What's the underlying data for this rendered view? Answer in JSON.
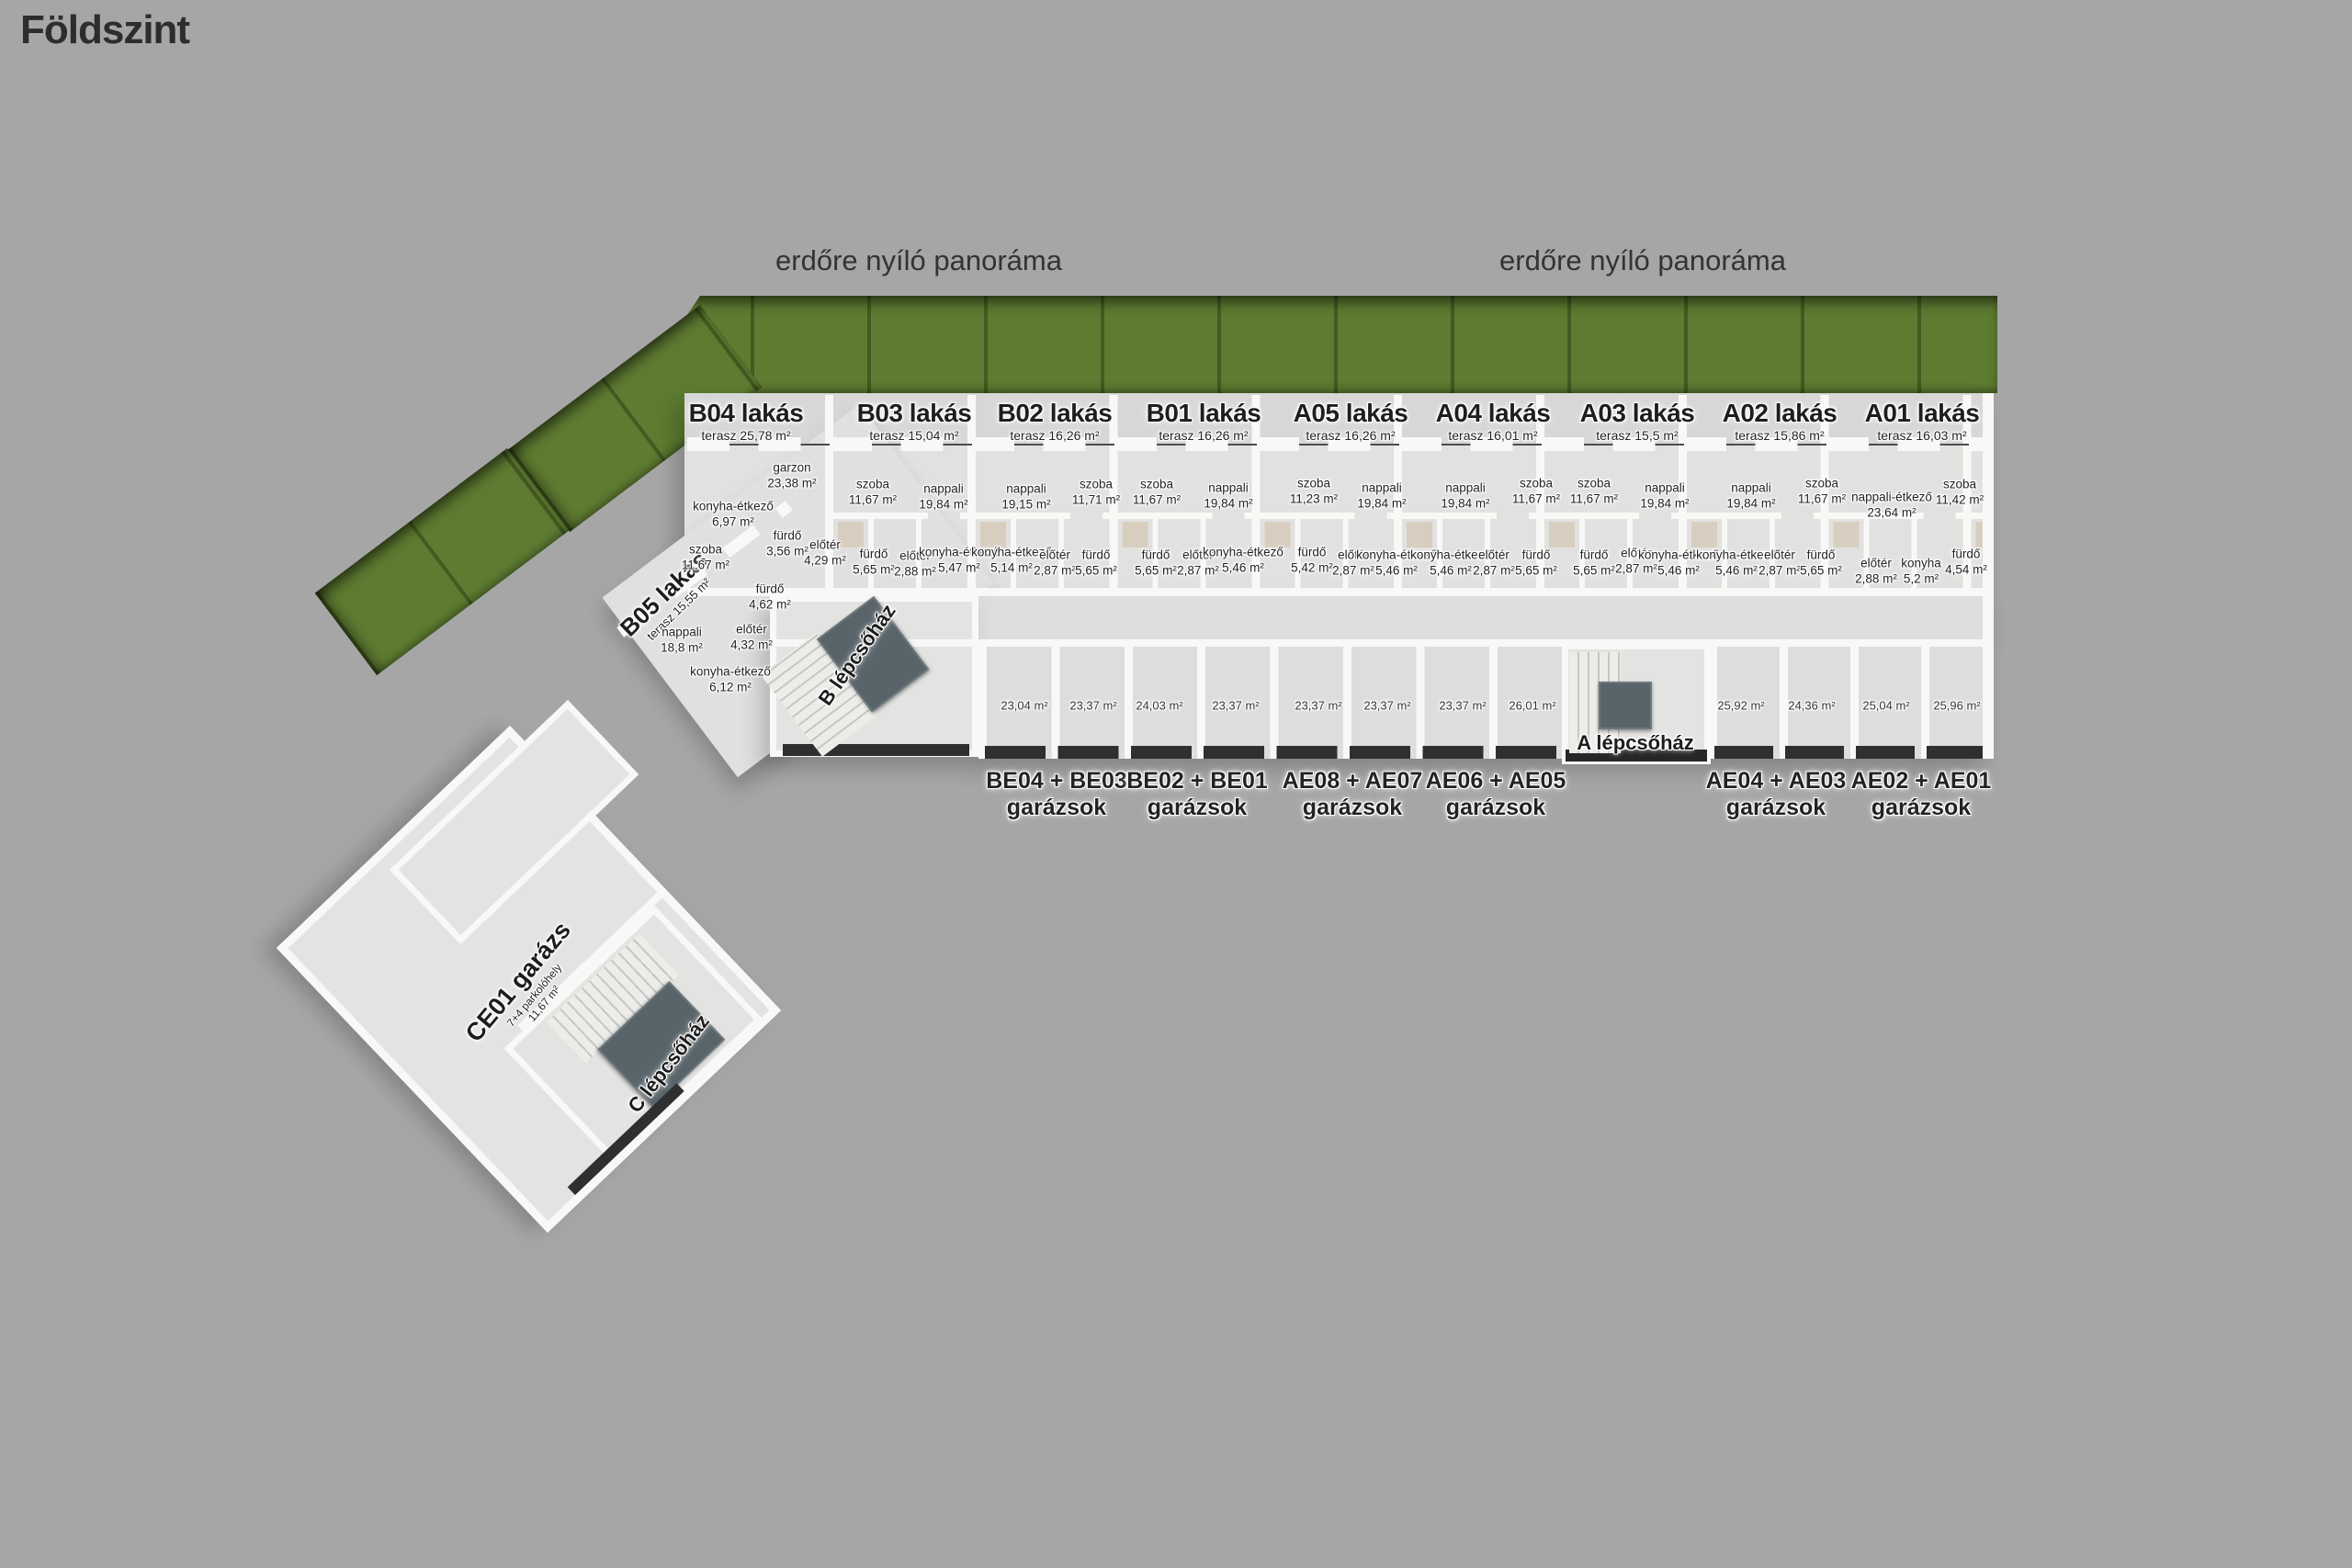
{
  "title": "Földszint",
  "panorama": {
    "left": "erdőre nyíló panoráma",
    "right": "erdőre nyíló panoráma"
  },
  "apartments": [
    {
      "name": "B05 lakás",
      "terasz": "terasz 15,55 m²"
    },
    {
      "name": "B04 lakás",
      "terasz": "terasz 25,78 m²"
    },
    {
      "name": "B03 lakás",
      "terasz": "terasz 15,04 m²"
    },
    {
      "name": "B02 lakás",
      "terasz": "terasz 16,26 m²"
    },
    {
      "name": "B01 lakás",
      "terasz": "terasz 16,26 m²"
    },
    {
      "name": "A05 lakás",
      "terasz": "terasz 16,26 m²"
    },
    {
      "name": "A04 lakás",
      "terasz": "terasz 16,01 m²"
    },
    {
      "name": "A03 lakás",
      "terasz": "terasz 15,5 m²"
    },
    {
      "name": "A02 lakás",
      "terasz": "terasz 15,86 m²"
    },
    {
      "name": "A01 lakás",
      "terasz": "terasz 16,03 m²"
    }
  ],
  "rooms": [
    {
      "label": "szoba",
      "area": "11,67 m²"
    },
    {
      "label": "nappali",
      "area": "18,8 m²"
    },
    {
      "label": "konyha-étkező",
      "area": "6,12 m²"
    },
    {
      "label": "előtér",
      "area": "4,32 m²"
    },
    {
      "label": "fürdő",
      "area": "4,62 m²"
    },
    {
      "label": "garzon",
      "area": "23,38 m²"
    },
    {
      "label": "konyha-étkező",
      "area": "6,97 m²"
    },
    {
      "label": "fürdő",
      "area": "3,56 m²"
    },
    {
      "label": "előtér",
      "area": "4,29 m²"
    },
    {
      "label": "szoba",
      "area": "11,67 m²"
    },
    {
      "label": "nappali",
      "area": "19,84 m²"
    },
    {
      "label": "fürdő",
      "area": "5,65 m²"
    },
    {
      "label": "előtér",
      "area": "2,88 m²"
    },
    {
      "label": "konyha-étkező",
      "area": "5,47 m²"
    },
    {
      "label": "nappali",
      "area": "19,15 m²"
    },
    {
      "label": "szoba",
      "area": "11,71 m²"
    },
    {
      "label": "konyha-étkező",
      "area": "5,14 m²"
    },
    {
      "label": "előtér",
      "area": "2,87 m²"
    },
    {
      "label": "fürdő",
      "area": "5,65 m²"
    },
    {
      "label": "szoba",
      "area": "11,67 m²"
    },
    {
      "label": "fürdő",
      "area": "5,65 m²"
    },
    {
      "label": "előtér",
      "area": "2,87 m²"
    },
    {
      "label": "nappali",
      "area": "19,84 m²"
    },
    {
      "label": "konyha-étkező",
      "area": "5,46 m²"
    },
    {
      "label": "szoba",
      "area": "11,23 m²"
    },
    {
      "label": "nappali",
      "area": "19,84 m²"
    },
    {
      "label": "fürdő",
      "area": "5,42 m²"
    },
    {
      "label": "előtér",
      "area": "2,87 m²"
    },
    {
      "label": "konyha-étkező",
      "area": "5,46 m²"
    },
    {
      "label": "nappali",
      "area": "19,84 m²"
    },
    {
      "label": "konyha-étkező",
      "area": "5,46 m²"
    },
    {
      "label": "előtér",
      "area": "2,87 m²"
    },
    {
      "label": "szoba",
      "area": "11,67 m²"
    },
    {
      "label": "fürdő",
      "area": "5,65 m²"
    },
    {
      "label": "szoba",
      "area": "11,67 m²"
    },
    {
      "label": "fürdő",
      "area": "5,65 m²"
    },
    {
      "label": "nappali",
      "area": "19,84 m²"
    },
    {
      "label": "előtér",
      "area": "2,87 m²"
    },
    {
      "label": "konyha-étkező",
      "area": "5,46 m²"
    },
    {
      "label": "nappali",
      "area": "19,84 m²"
    },
    {
      "label": "konyha-étkező",
      "area": "5,46 m²"
    },
    {
      "label": "előtér",
      "area": "2,87 m²"
    },
    {
      "label": "szoba",
      "area": "11,67 m²"
    },
    {
      "label": "fürdő",
      "area": "5,65 m²"
    },
    {
      "label": "nappali-étkező",
      "area": "23,64 m²"
    },
    {
      "label": "szoba",
      "area": "11,42 m²"
    },
    {
      "label": "előtér",
      "area": "2,88 m²"
    },
    {
      "label": "konyha",
      "area": "5,2 m²"
    },
    {
      "label": "fürdő",
      "area": "4,54 m²"
    }
  ],
  "garages": {
    "cells": [
      "23,04 m²",
      "23,37 m²",
      "24,03 m²",
      "23,37 m²",
      "23,37 m²",
      "23,37 m²",
      "23,37 m²",
      "26,01 m²",
      "25,92 m²",
      "24,36 m²",
      "25,04 m²",
      "25,96 m²"
    ],
    "groups": [
      {
        "units": "BE04 + BE03",
        "type": "garázsok"
      },
      {
        "units": "BE02 + BE01",
        "type": "garázsok"
      },
      {
        "units": "AE08 + AE07",
        "type": "garázsok"
      },
      {
        "units": "AE06 + AE05",
        "type": "garázsok"
      },
      {
        "units": "AE04 + AE03",
        "type": "garázsok"
      },
      {
        "units": "AE02 + AE01",
        "type": "garázsok"
      }
    ]
  },
  "staircases": {
    "a": "A lépcsőház",
    "b": "B lépcsőház",
    "c": "C lépcsőház"
  },
  "ce01": {
    "name": "CE01 garázs",
    "capacity": "7+4 parkolóhely",
    "unit_area": "11,67 m²"
  },
  "colors": {
    "background": "#a6a6a6",
    "floor": "#e1e1e0",
    "wall": "#f8f8f6",
    "hedge": "#5d7b31",
    "door": "#2f2f2f",
    "stair_platform": "#59646a"
  }
}
